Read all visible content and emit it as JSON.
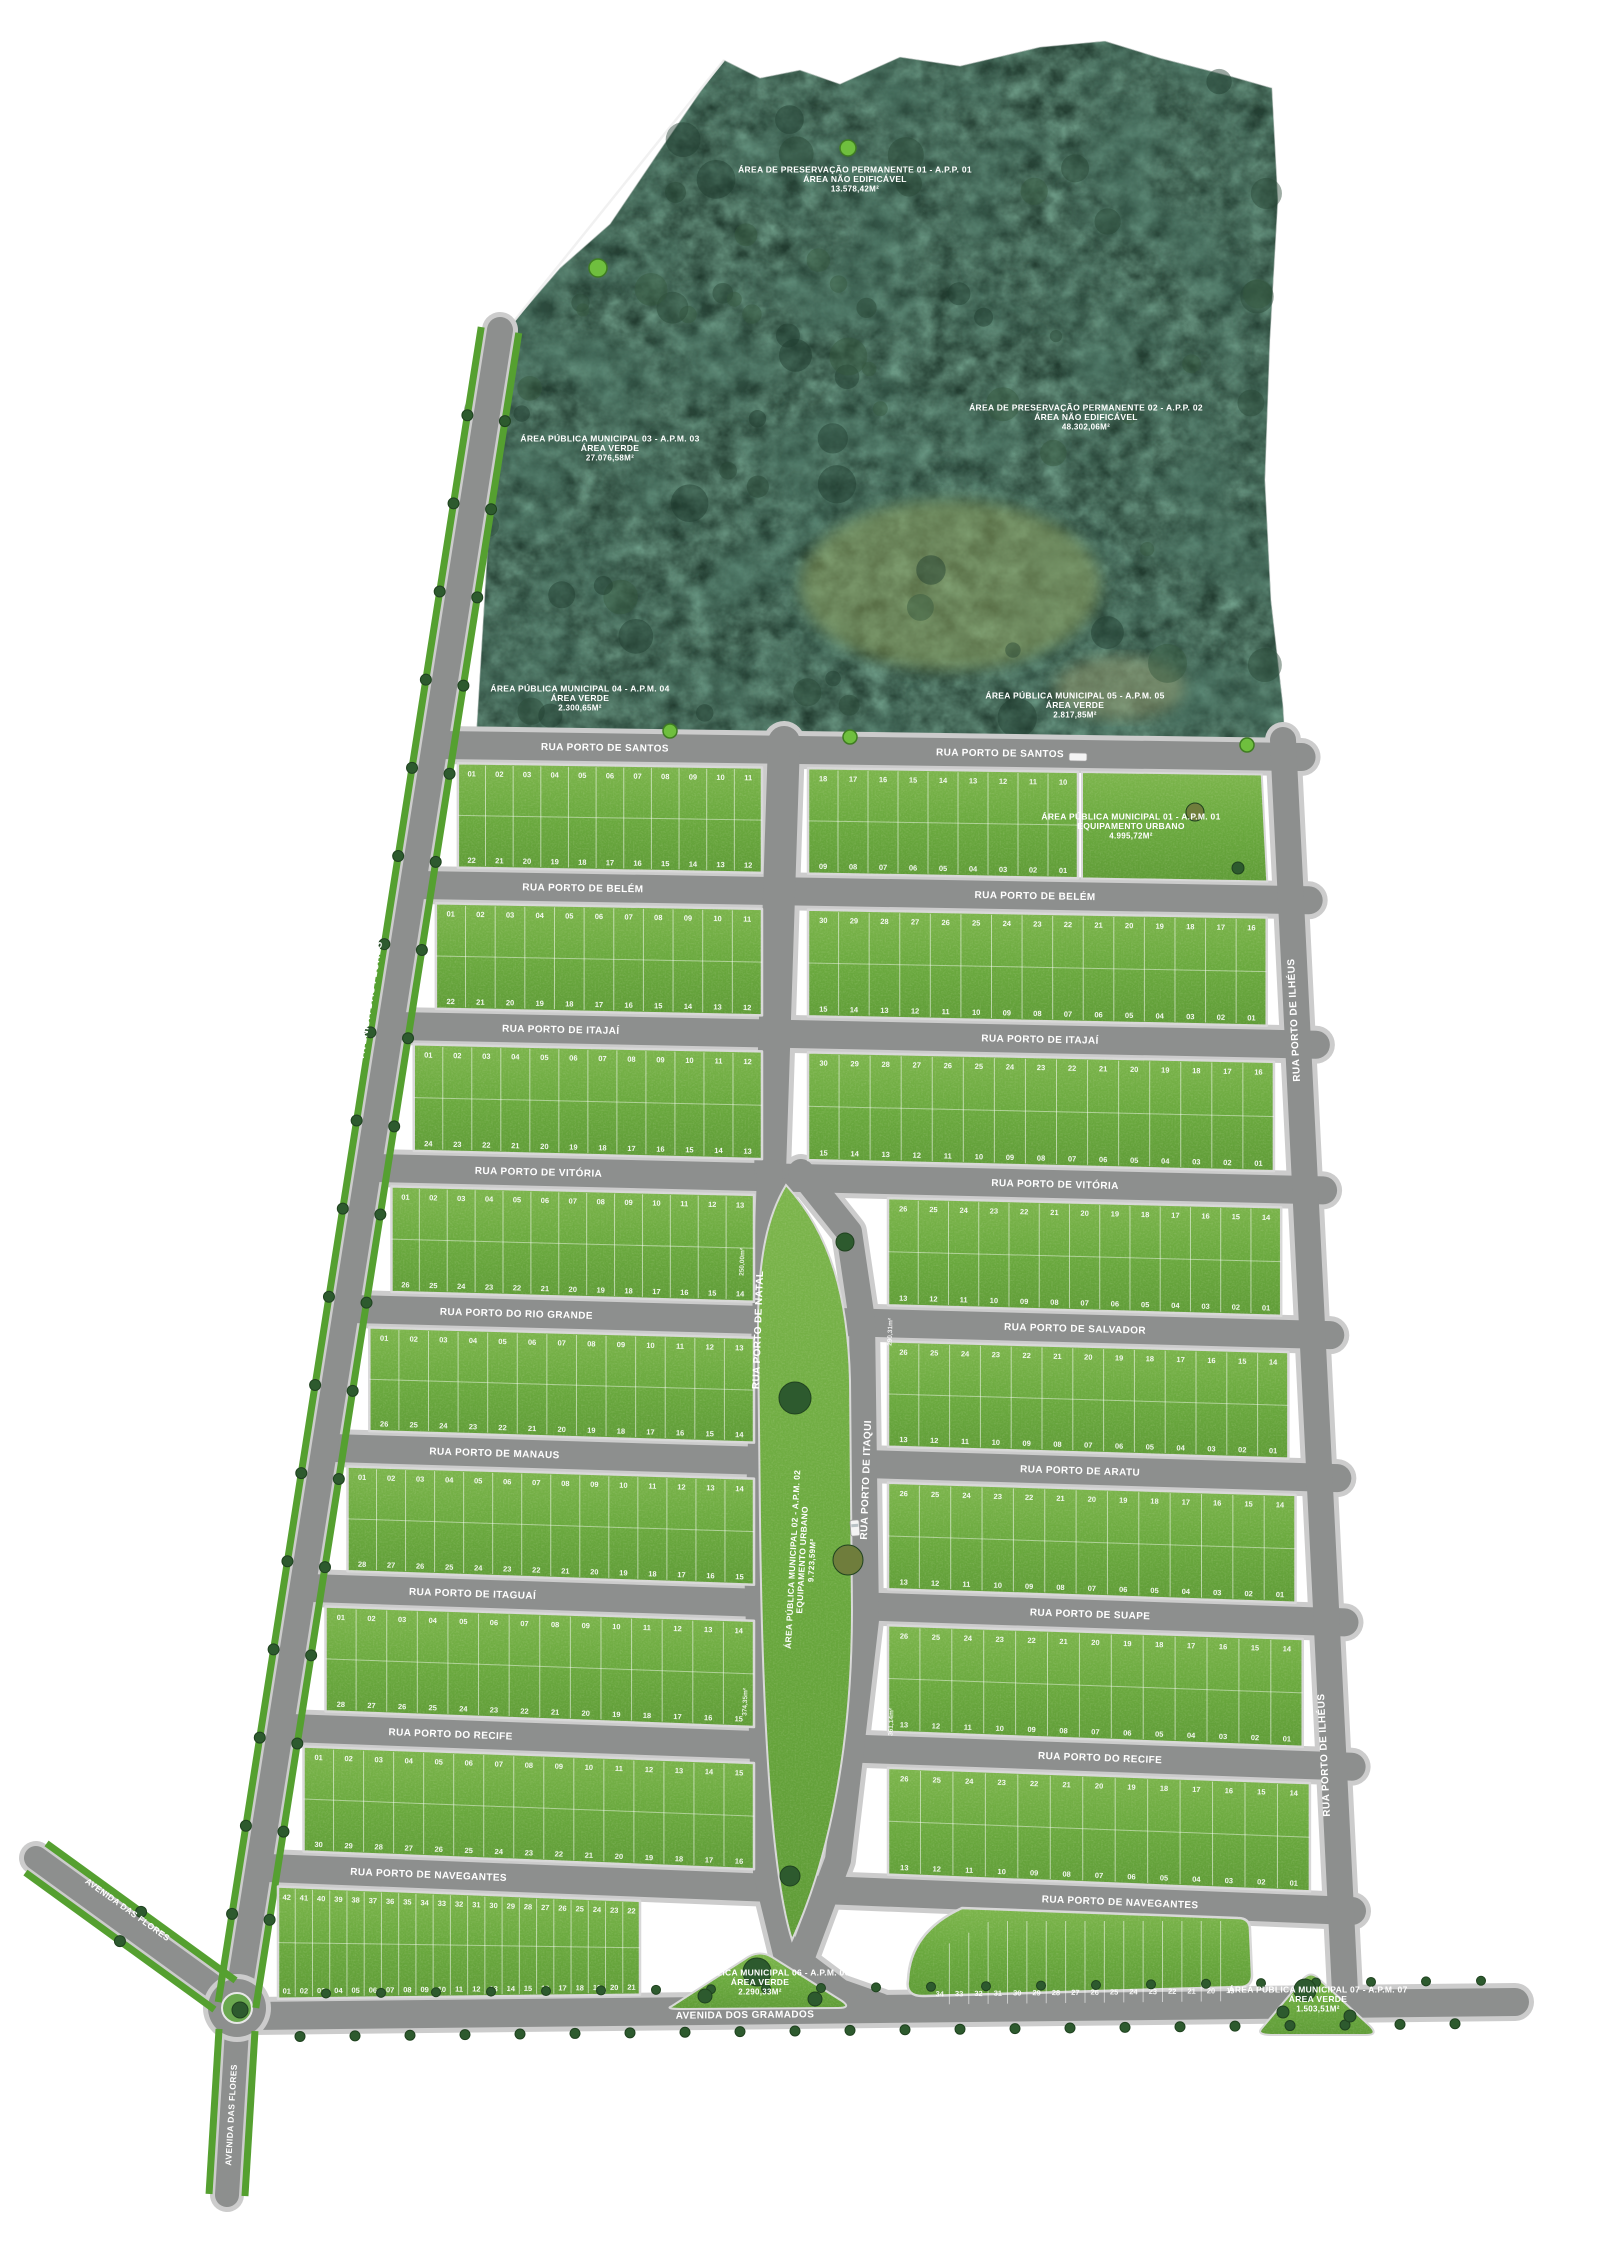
{
  "map": {
    "title": "Planta de loteamento urbano",
    "colors": {
      "background": "#ffffff",
      "forest": "#2b483a",
      "grass": "#74b047",
      "grass_dark": "#5e9c38",
      "road": "#8d8f8e",
      "curb": "#cccccc",
      "verge_green": "#55a030",
      "tree_dark": "#2d5a2e",
      "tree_olive": "#6f7d3c",
      "label": "#ffffff"
    },
    "preservation_areas": [
      {
        "id": "app01",
        "line1": "ÁREA DE PRESERVAÇÃO PERMANENTE 01 - A.P.P. 01",
        "line2": "ÁREA NÃO EDIFICÁVEL",
        "area": "13.578,42M²"
      },
      {
        "id": "app02",
        "line1": "ÁREA DE PRESERVAÇÃO PERMANENTE 02 - A.P.P. 02",
        "line2": "ÁREA NÃO EDIFICÁVEL",
        "area": "48.302,06M²"
      }
    ],
    "public_areas": [
      {
        "id": "apm01",
        "line1": "ÁREA PÚBLICA MUNICIPAL 01 - A.P.M. 01",
        "line2": "EQUIPAMENTO URBANO",
        "area": "4.995,72M²"
      },
      {
        "id": "apm02",
        "line1": "ÁREA PÚBLICA MUNICIPAL 02 - A.P.M. 02",
        "line2": "EQUIPAMENTO URBANO",
        "area": "9.723,59M²"
      },
      {
        "id": "apm03",
        "line1": "ÁREA PÚBLICA MUNICIPAL 03 - A.P.M. 03",
        "line2": "ÁREA VERDE",
        "area": "27.076,58M²"
      },
      {
        "id": "apm04",
        "line1": "ÁREA PÚBLICA MUNICIPAL 04 - A.P.M. 04",
        "line2": "ÁREA VERDE",
        "area": "2.300,65M²"
      },
      {
        "id": "apm05",
        "line1": "ÁREA PÚBLICA MUNICIPAL 05 - A.P.M. 05",
        "line2": "ÁREA VERDE",
        "area": "2.817,85M²"
      },
      {
        "id": "apm06",
        "line1": "ÁREA PÚBLICA MUNICIPAL 06 - A.P.M. 06",
        "line2": "ÁREA VERDE",
        "area": "2.290,33M²"
      },
      {
        "id": "apm07",
        "line1": "ÁREA PÚBLICA MUNICIPAL 07 - A.P.M. 07",
        "line2": "ÁREA VERDE",
        "area": "1.503,51M²"
      }
    ],
    "streets": {
      "horizontal": [
        {
          "left": "RUA PORTO DE SANTOS",
          "right": "RUA PORTO DE SANTOS"
        },
        {
          "left": "RUA PORTO DE BELÉM",
          "right": "RUA PORTO DE BELÉM"
        },
        {
          "left": "RUA PORTO DE ITAJAÍ",
          "right": "RUA PORTO DE ITAJAÍ"
        },
        {
          "left": "RUA PORTO DE VITÓRIA",
          "right": "RUA PORTO DE VITÓRIA"
        },
        {
          "left": "RUA PORTO DO RIO GRANDE",
          "right": "RUA PORTO DE SALVADOR"
        },
        {
          "left": "RUA PORTO DE MANAUS",
          "right": "RUA PORTO DE ARATU"
        },
        {
          "left": "RUA PORTO DE ITAGUAÍ",
          "right": "RUA PORTO DE SUAPE"
        },
        {
          "left": "RUA PORTO DO RECIFE",
          "right": "RUA PORTO DO RECIFE"
        },
        {
          "left": "RUA PORTO DE NAVEGANTES",
          "right": "RUA PORTO DE NAVEGANTES"
        }
      ],
      "vertical": [
        {
          "id": "natal",
          "label": "RUA PORTO DE NATAL"
        },
        {
          "id": "itaqui",
          "label": "RUA PORTO DE ITAQUI"
        },
        {
          "id": "ilheus_north",
          "label": "RUA PORTO DE ILHÉUS"
        },
        {
          "id": "ilheus_south",
          "label": "RUA PORTO DE ILHÉUS"
        }
      ],
      "avenues": [
        {
          "id": "gramados",
          "label": "AVENIDA DOS GRAMADOS"
        },
        {
          "id": "flores_west",
          "label": "AVENIDA DAS FLORES"
        },
        {
          "id": "flores_south",
          "label": "AVENIDA DAS FLORES"
        },
        {
          "id": "flores_nw",
          "label": "AVENIDA DAS FLORES"
        }
      ]
    },
    "blocks": {
      "numbering": {
        "left_blocks": "top edge ascending 01..n, bottom edge descending 2n..n+1",
        "right_blocks": "top edge descending 2n..n+1, bottom edge descending n..01",
        "bottom_left_block": "top edge descending, bottom edge ascending 01..n",
        "fan_block": "bottom edge descending"
      },
      "rows": [
        {
          "left_lots": 11,
          "right_lots": 9
        },
        {
          "left_lots": 11,
          "right_lots": 15
        },
        {
          "left_lots": 12,
          "right_lots": 15
        },
        {
          "left_lots": 13,
          "right_lots": 13
        },
        {
          "left_lots": 13,
          "right_lots": 13
        },
        {
          "left_lots": 14,
          "right_lots": 13
        },
        {
          "left_lots": 14,
          "right_lots": 13
        },
        {
          "left_lots": 15,
          "right_lots": 13
        },
        {
          "left_lots": 21,
          "right_lots": 16
        }
      ]
    },
    "lot_area_samples": [
      "250,00m²",
      "290,31m²",
      "361,14m²",
      "374,35m²"
    ]
  }
}
